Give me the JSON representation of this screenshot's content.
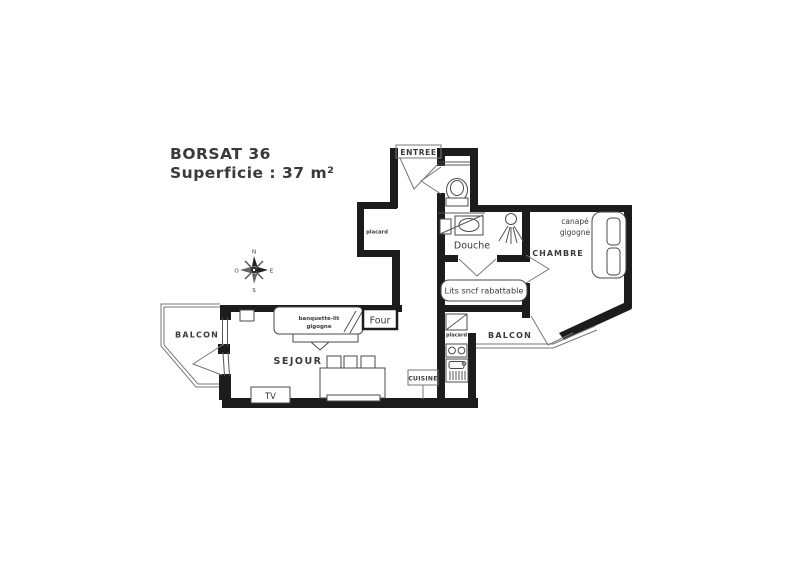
{
  "title": {
    "line1": "BORSAT 36",
    "line2": "Superficie : 37 m²"
  },
  "labels": {
    "entree": "ENTREE",
    "placard_entry": "placard",
    "douche": "Douche",
    "canape_line1": "canapé",
    "canape_line2": "gigogne",
    "chambre": "CHAMBRE",
    "lits_sncf": "Lits sncf rabattable",
    "balcon_right": "BALCON",
    "balcon_left": "BALCON",
    "placard_kitchen": "placard",
    "cuisine": "CUISINE",
    "sejour": "SEJOUR",
    "banquette_line1": "banquette-lit",
    "banquette_line2": "gigogne",
    "four": "Four",
    "tv": "TV"
  },
  "compass": {
    "north": "N",
    "south": "S",
    "east": "E",
    "west": "O"
  },
  "colors": {
    "wall": "#1c1c1c",
    "text": "#3a3a3a",
    "thin_line": "#555555",
    "background": "#ffffff"
  }
}
